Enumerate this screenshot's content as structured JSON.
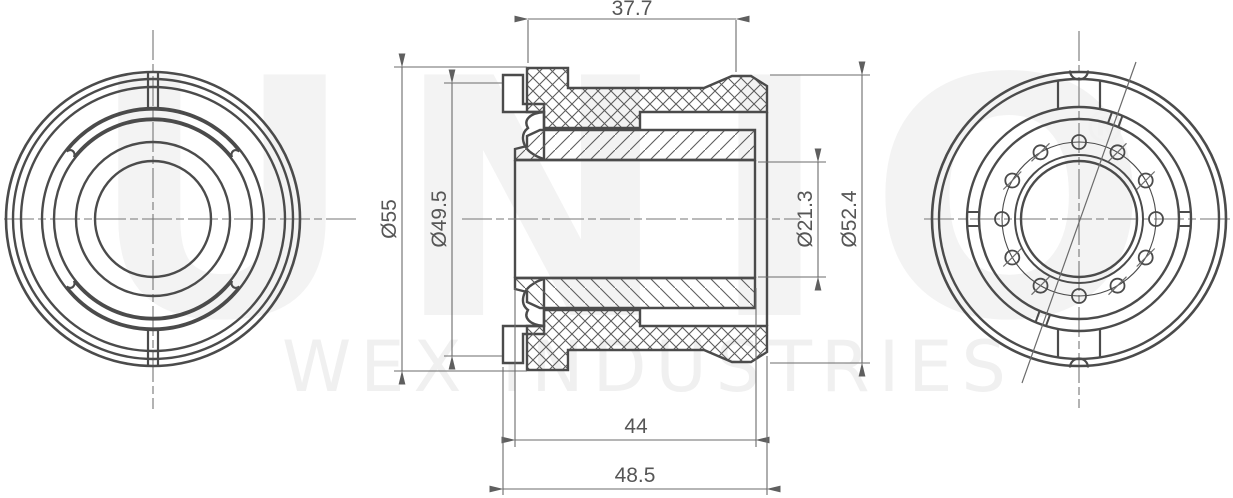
{
  "drawing": {
    "type": "technical-drawing-3-views",
    "views": {
      "left": "front-view",
      "middle": "cross-section-view",
      "right": "rear-view"
    },
    "dimensions": {
      "top_width": "37.7",
      "bottom_inner_length": "44",
      "bottom_overall_length": "48.5",
      "left_outer_diameter": "Ø55",
      "left_sleeve_diameter": "Ø49.5",
      "right_bore_diameter": "Ø21.3",
      "right_end_diameter": "Ø52.4"
    },
    "watermark": {
      "brand": "UNIO",
      "registered_mark": "®",
      "company": "WEX INDUSTRIES"
    },
    "colors": {
      "outline": "#4b4b4b",
      "thin_line": "#6b6b6b",
      "dim_text": "#565656",
      "watermark_light": "#f3f3f3",
      "background": "#ffffff"
    }
  }
}
